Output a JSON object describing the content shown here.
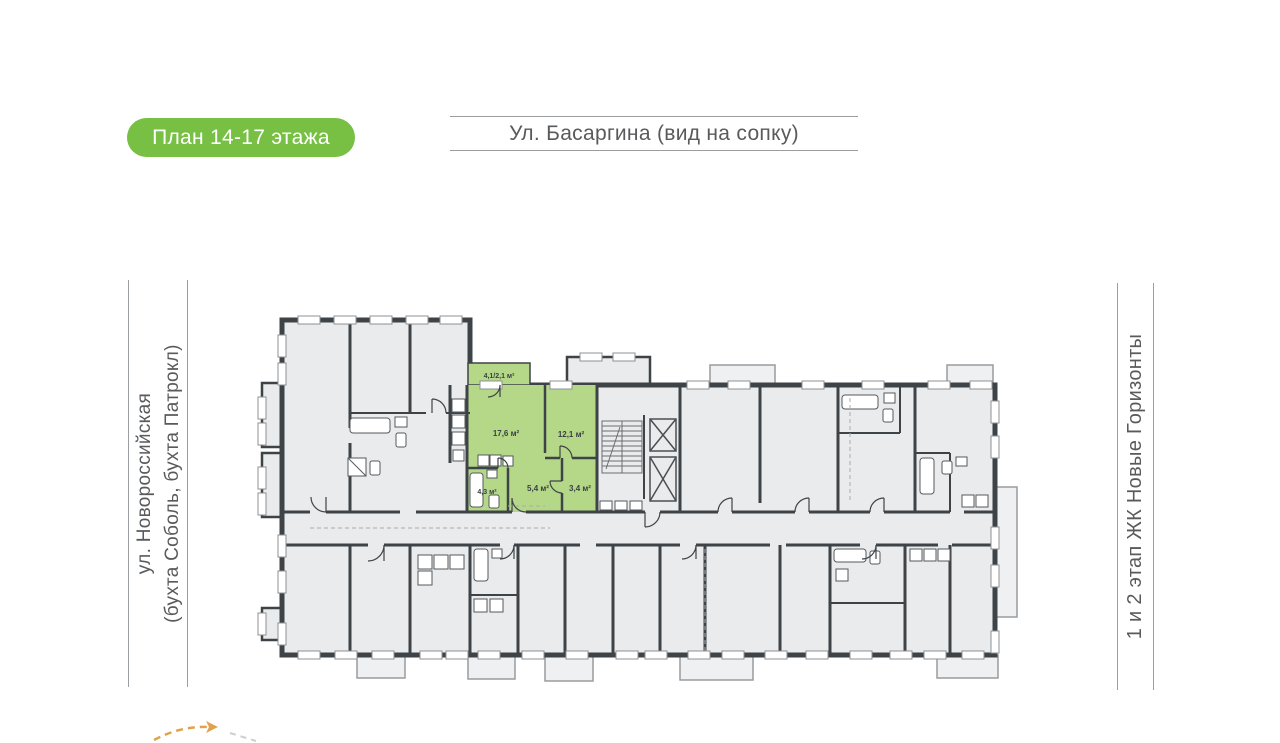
{
  "page": {
    "title_badge": "План 14-17 этажа"
  },
  "header": {
    "street_top": "Ул. Басаргина (вид на сопку)"
  },
  "left_sidebar": {
    "street_line1": "ул. Новороссийская",
    "street_line2": "(бухта Соболь, бухта Патрокл)"
  },
  "right_sidebar": {
    "label": "1 и 2 этап ЖК Новые Горизонты"
  },
  "plan": {
    "highlighted_apartment": {
      "highlight_color": "#b4d888",
      "rooms": [
        {
          "name": "balcony",
          "area_label": "4,1/2,1 м²"
        },
        {
          "name": "living-room",
          "area_label": "17,6 м²"
        },
        {
          "name": "bedroom",
          "area_label": "12,1 м²"
        },
        {
          "name": "bathroom",
          "area_label": "4,3 м²"
        },
        {
          "name": "hallway",
          "area_label": "5,4 м²"
        },
        {
          "name": "wc",
          "area_label": "3,4 м²"
        }
      ]
    },
    "colors": {
      "wall": "#3e4347",
      "room_fill": "#e9ebec",
      "badge_green": "#77c044",
      "accent_orange": "#e2a24c",
      "text_gray": "#595a5c"
    }
  }
}
